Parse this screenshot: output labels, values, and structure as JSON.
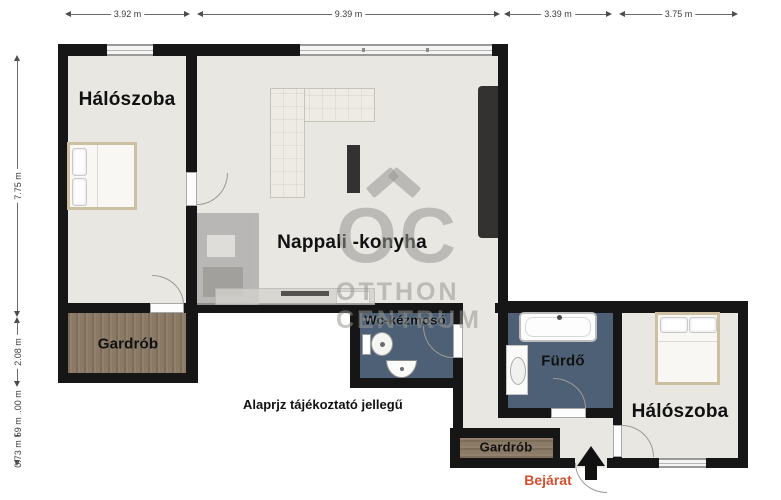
{
  "plan": {
    "rooms": {
      "bedroom_left": {
        "label": "Hálószoba"
      },
      "living_kitchen": {
        "label": "Nappali -konyha"
      },
      "wardrobe_left": {
        "label": "Gardrób"
      },
      "wc": {
        "label": "Wc-kézmosó"
      },
      "bathroom": {
        "label": "Fürdő"
      },
      "bedroom_right": {
        "label": "Hálószoba"
      },
      "wardrobe_entry": {
        "label": "Gardrób"
      }
    },
    "entrance": {
      "label": "Bejárat",
      "color": "#d4502e"
    },
    "disclaimer": "Alaprjz tájékoztató jellegű",
    "watermark": {
      "monogram": "OC",
      "line1": "OTTHON",
      "line2": "CENTRUM"
    },
    "dimensions": {
      "top": [
        {
          "label": "3.92 m"
        },
        {
          "label": "9.39 m"
        },
        {
          "label": "3.39 m"
        },
        {
          "label": "3.75 m"
        }
      ],
      "left": [
        {
          "label": "7.75 m"
        },
        {
          "label": "2.08 m"
        },
        {
          "label": "1.00 m"
        },
        {
          "label": "0.59 m"
        },
        {
          "label": "0.73 m"
        }
      ]
    },
    "colors": {
      "wall": "#161616",
      "floor": "#e8e7e2",
      "wet_floor": "#4e6075",
      "wood_floor": "#8b7a66",
      "entrance_accent": "#d4502e",
      "watermark": "#9a9a96"
    }
  }
}
